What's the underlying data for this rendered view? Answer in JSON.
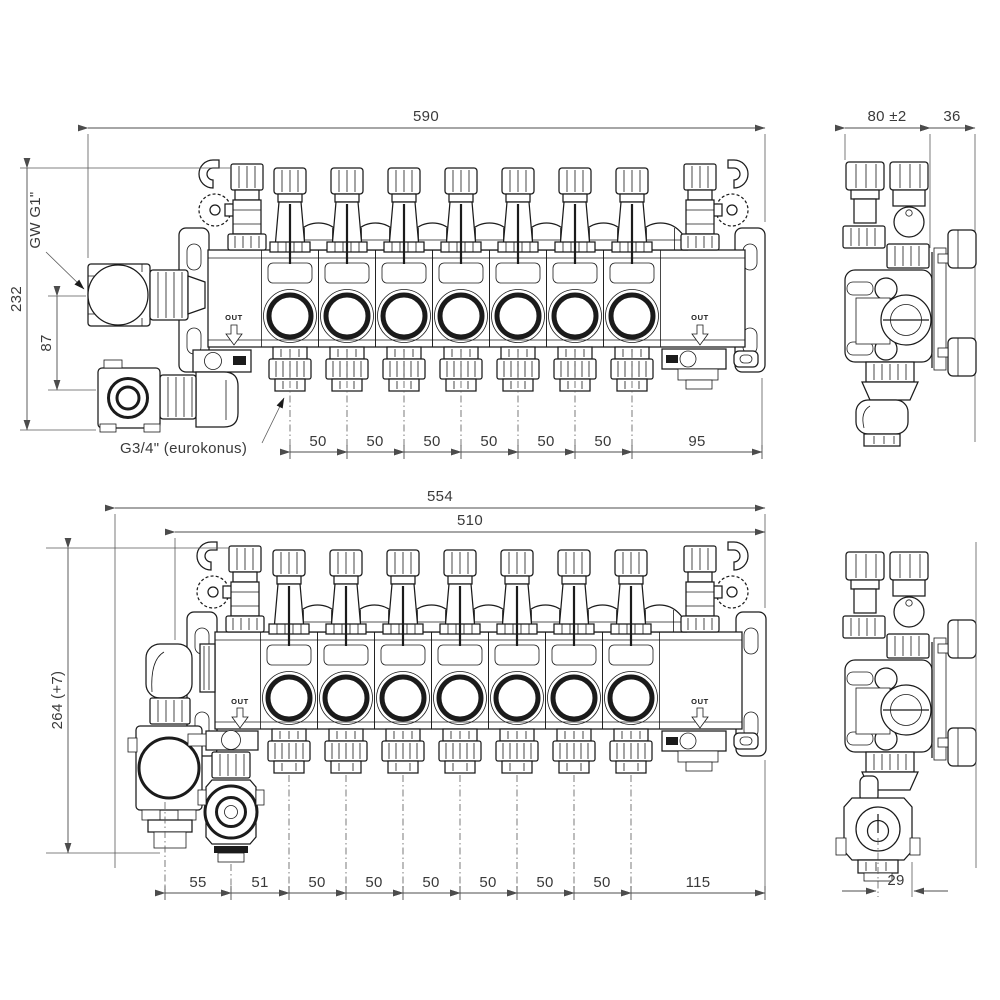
{
  "drawing": {
    "front_top": {
      "dim_overall": "590",
      "dim_height": "232",
      "dim_port_offset": "87",
      "label_thread_supply": "GW G1\"",
      "label_thread_outlets": "G3/4\" (eurokonus)",
      "dim_segments": [
        "50",
        "50",
        "50",
        "50",
        "50",
        "50",
        "95"
      ],
      "label_out": "OUT"
    },
    "side_top": {
      "dim_depth": "80 ±2",
      "dim_bracket": "36"
    },
    "front_bottom": {
      "dim_overall": "554",
      "dim_inner": "510",
      "dim_height": "264 (+7)",
      "dim_segments": [
        "55",
        "51",
        "50",
        "50",
        "50",
        "50",
        "50",
        "50",
        "115"
      ],
      "label_out": "OUT"
    },
    "side_bottom": {
      "dim_offset": "29"
    }
  },
  "colors": {
    "line": "#1b1b1b",
    "dimension": "#4c4c4c",
    "background": "#ffffff"
  }
}
